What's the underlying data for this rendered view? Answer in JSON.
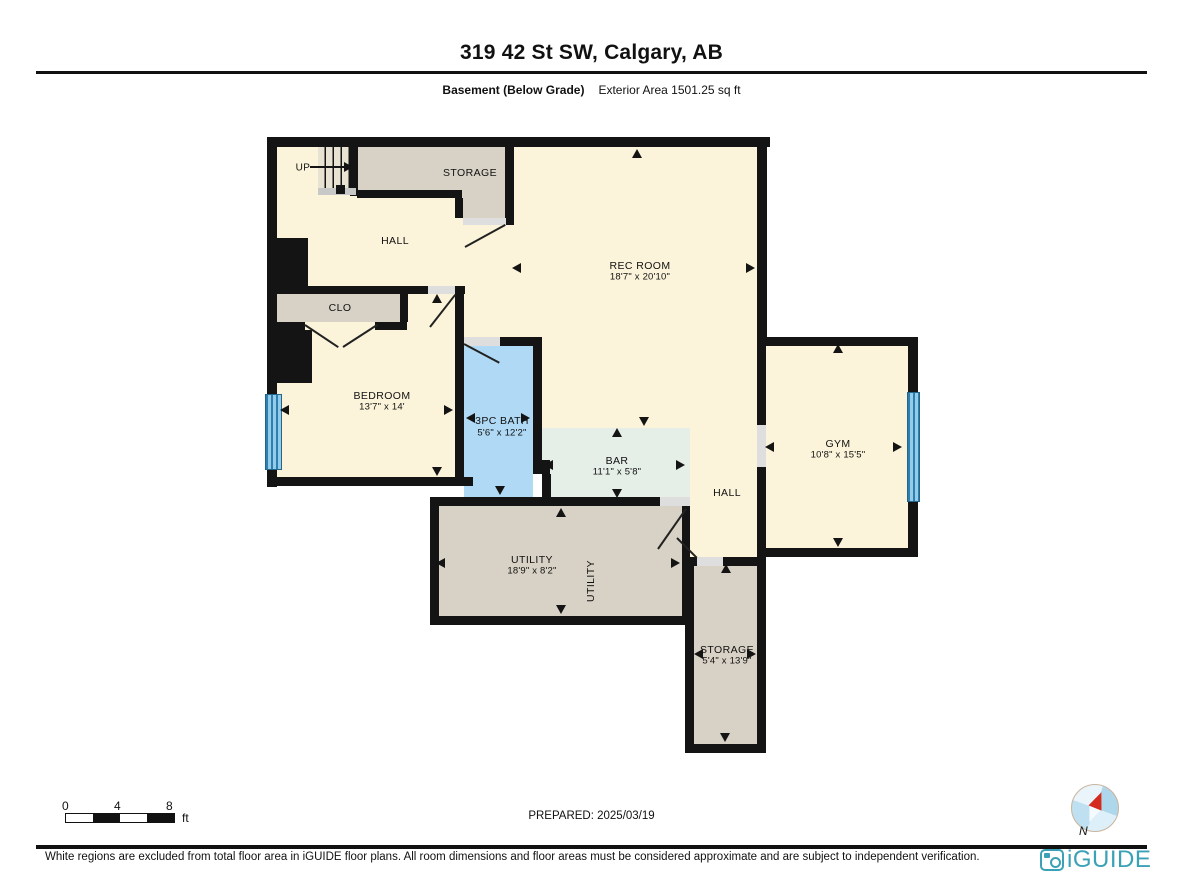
{
  "header": {
    "title": "319 42 St SW, Calgary, AB",
    "floor_label": "Basement (Below Grade)",
    "area_label": "Exterior Area 1501.25 sq ft"
  },
  "plan": {
    "stairs_label": "UP",
    "rooms": {
      "hall_top": {
        "name": "HALL"
      },
      "storage_top": {
        "name": "STORAGE"
      },
      "rec_room": {
        "name": "REC ROOM",
        "dims": "18'7\" x 20'10\""
      },
      "clo": {
        "name": "CLO"
      },
      "bedroom": {
        "name": "BEDROOM",
        "dims": "13'7\" x 14'"
      },
      "bath": {
        "name": "3PC BATH",
        "dims": "5'6\" x 12'2\""
      },
      "bar": {
        "name": "BAR",
        "dims": "11'1\" x 5'8\""
      },
      "hall_right": {
        "name": "HALL"
      },
      "gym": {
        "name": "GYM",
        "dims": "10'8\" x 15'5\""
      },
      "utility": {
        "name": "UTILITY",
        "dims": "18'9\" x 8'2\""
      },
      "utility_vertical": {
        "name": "UTILITY"
      },
      "storage_bottom": {
        "name": "STORAGE",
        "dims": "5'4\" x 13'9\""
      }
    },
    "colors": {
      "floor_cream": "#FBF4DA",
      "room_grey": "#D8D1C5",
      "bath_blue": "#AFD9F4",
      "bar_green": "#E5EFE8",
      "wall_black": "#141414",
      "window_blue": "#2F7FAE"
    }
  },
  "scale_bar": {
    "ticks": [
      "0",
      "4",
      "8"
    ],
    "unit": "ft"
  },
  "compass": {
    "label": "N"
  },
  "footer": {
    "prepared": "PREPARED: 2025/03/19",
    "disclaimer": "White regions are excluded from total floor area in iGUIDE floor plans. All room dimensions and floor areas must be considered approximate and are subject to independent verification.",
    "brand": "iGUIDE"
  }
}
